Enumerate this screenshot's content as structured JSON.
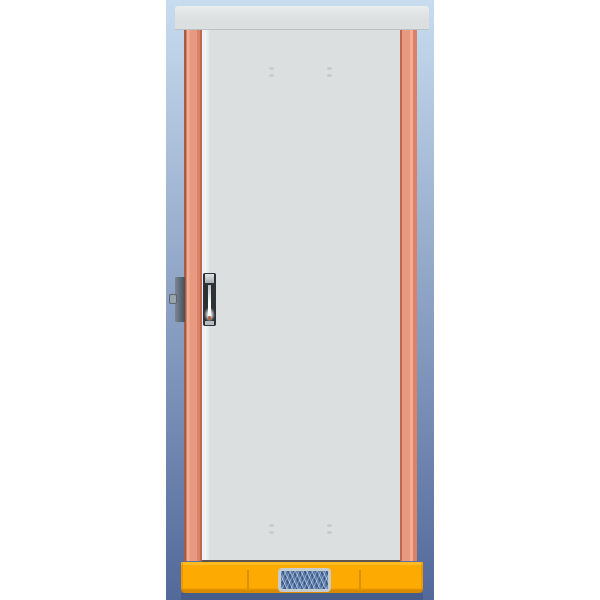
{
  "meta": {
    "subject": "3D CAD render of an industrial electrical enclosure cabinet, front view, closed door",
    "canvas": {
      "width": 600,
      "height": 600
    }
  },
  "colors": {
    "outer": "#ffffff",
    "bg_top": "#c8dcef",
    "bg_bottom": "#52699a",
    "cap": "#dcdfe0",
    "cap_highlight": "#e9edee",
    "cap_shadow": "#b9c2c6",
    "door": "#dbdfdf",
    "door_edge_highlight": "#f0f3f3",
    "door_bottom_line": "#5e564f",
    "screw_dot": "#c5cbcc",
    "rail_main": "#e89a80",
    "rail_light": "#f2ad94",
    "rail_shade": "#d98169",
    "rail_dark": "#c0684f",
    "rail_darker": "#a85a42",
    "plinth": "#fdaa02",
    "plinth_top": "#ffbb20",
    "plinth_dark": "#d88a00",
    "plinth_seam": "#dd9000",
    "plinth_shadow": "rgba(28,44,79,0.22)",
    "vent_frame": "#c6cbcd",
    "vent_mesh": "#5b7db0",
    "vent_mesh_dark": "#3f5a85",
    "vent_mesh_light": "#93adce",
    "handle_frame": "#2d3238",
    "handle_top_cap_light": "#dfe3e4",
    "handle_top_cap_dark": "#a9b0b3",
    "handle_bottom_cap": "#b5bbbd",
    "lever_light": "#ffffff",
    "lever_dark": "#b9c0c4",
    "keyhole": "#b5603e",
    "hinge_light": "#7b8793",
    "hinge_dark": "#46505b",
    "hinge_pin": "#99a3ab",
    "hinge_pin_edge": "#5c666f"
  },
  "parts": {
    "backdrop": "blue gradient viewport background band",
    "top_cap": "cabinet roof cap",
    "left_rail": "left frame upright (salmon)",
    "right_rail": "right frame upright (salmon)",
    "door": "front door panel (light gray)",
    "handle": "flush swing handle with lock cylinder",
    "lock_block": "side lock/latch block with pin",
    "plinth": "orange plinth base with panel seams",
    "vent": "woven ventilation grille in plinth"
  }
}
